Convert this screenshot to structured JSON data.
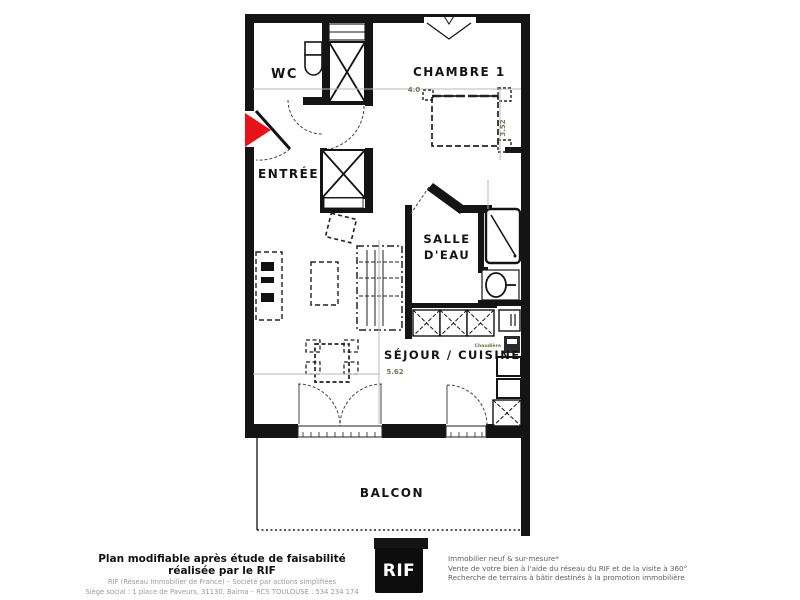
{
  "plan": {
    "rooms": {
      "wc": "WC",
      "chambre": "CHAMBRE 1",
      "entree": "ENTRÉE",
      "salle_eau_1": "SALLE",
      "salle_eau_2": "D'EAU",
      "sejour": "SÉJOUR / CUISINE",
      "balcon": "BALCON"
    },
    "dimensions": {
      "chambre_width": "4.0",
      "chambre_depth": "3.52",
      "sejour_width": "5.62"
    },
    "equipment": {
      "boiler": "Chaudière"
    },
    "colors": {
      "wall": "#141414",
      "entrance_arrow": "#e8121a",
      "dimension_text": "#6f7f55",
      "dimension_line": "#b8b8b8"
    }
  },
  "footer": {
    "left": {
      "title": "Plan modifiable après étude de faisabilité réalisée par le RIF",
      "line2": "RIF (Réseau Immobilier de France) – Société par actions simplifiées",
      "line3": "Siège social : 1 place de Paveurs, 31130, Balma – RCS TOULOUSE : 534 234 174"
    },
    "logo_text": "RIF",
    "right": {
      "line1": "Immobilier neuf & sur-mesure*",
      "line2": "Vente de votre bien à l'aide du réseau du RIF et de la visite à 360°",
      "line3": "Recherche de terrains à bâtir destinés à la promotion immobilière"
    }
  }
}
